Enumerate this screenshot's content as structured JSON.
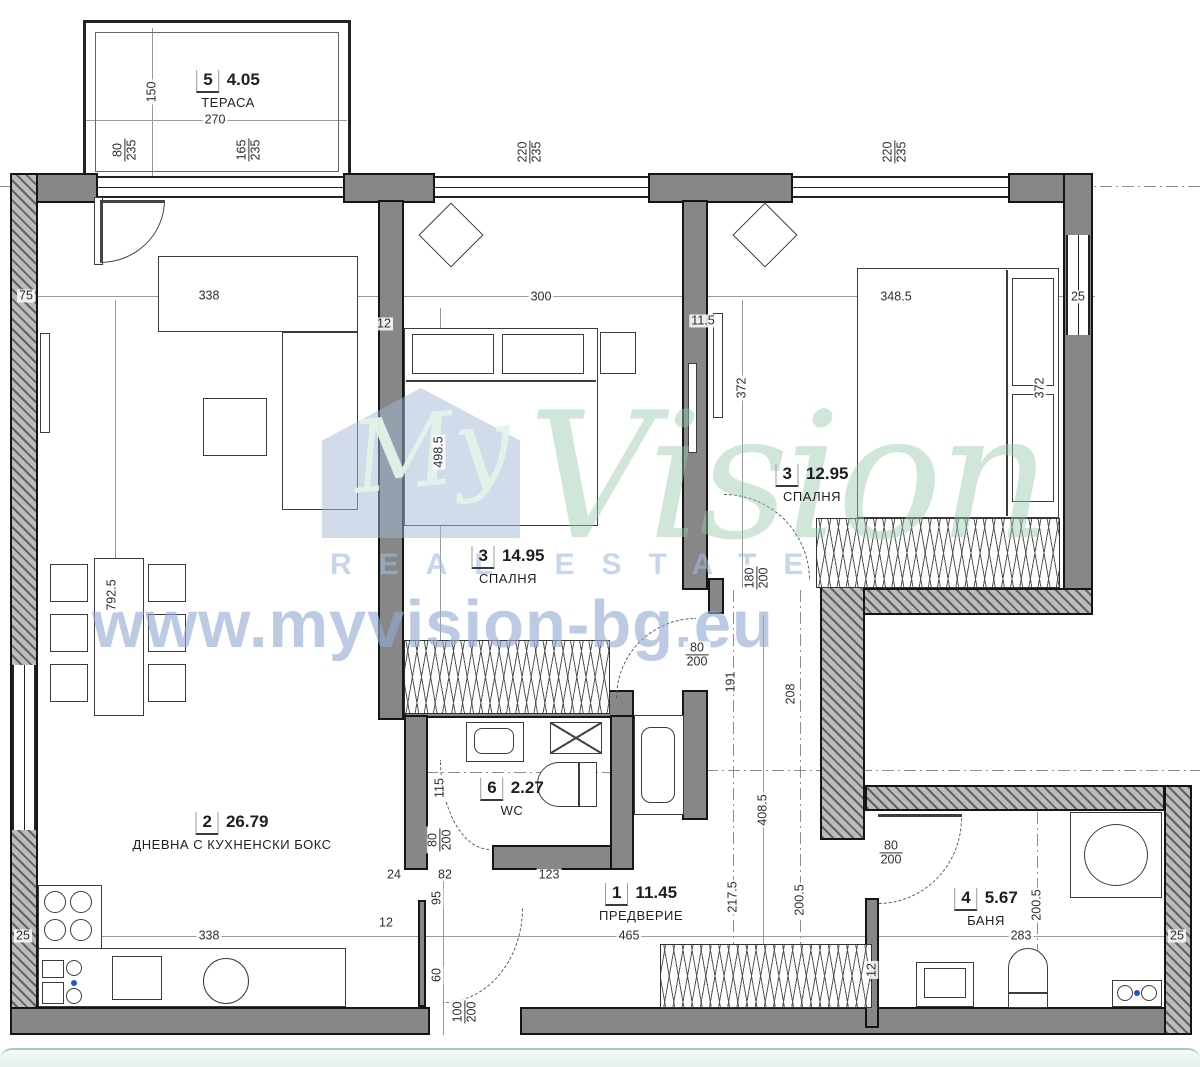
{
  "meta": {
    "width": 1200,
    "height": 1067,
    "drawing_type": "apartment floor plan"
  },
  "colors": {
    "wall_fill": "#878787",
    "wall_outline": "#151515",
    "hatch_fill": "#bcbcbc",
    "dim_text": "#2e2e2e",
    "watermark_green": "#96c7ab",
    "watermark_blue": "#94aad2",
    "band_green": "#a9cdb4"
  },
  "watermark": {
    "logo_text": "My",
    "brand": "Vision",
    "tagline": "REAL ESTATE",
    "url": "www.myvision-bg.eu"
  },
  "rooms": [
    {
      "num": "5",
      "area": "4.05",
      "name": "ТЕРАСА",
      "x": 228,
      "y": 70
    },
    {
      "num": "3",
      "area": "14.95",
      "name": "СПАЛНЯ",
      "x": 508,
      "y": 546
    },
    {
      "num": "3",
      "area": "12.95",
      "name": "СПАЛНЯ",
      "x": 812,
      "y": 464
    },
    {
      "num": "2",
      "area": "26.79",
      "name": "ДНЕВНА С КУХНЕНСКИ БОКС",
      "x": 232,
      "y": 812
    },
    {
      "num": "6",
      "area": "2.27",
      "name": "WC",
      "x": 512,
      "y": 778
    },
    {
      "num": "1",
      "area": "11.45",
      "name": "ПРЕДВЕРИЕ",
      "x": 641,
      "y": 883
    },
    {
      "num": "4",
      "area": "5.67",
      "name": "БАНЯ",
      "x": 986,
      "y": 888
    }
  ],
  "dimensions": [
    {
      "t": "150",
      "x": 152,
      "y": 92,
      "r": 1
    },
    {
      "t": "270",
      "x": 215,
      "y": 120
    },
    {
      "t": "80/235",
      "x": 125,
      "y": 150,
      "r": 1,
      "f": 1
    },
    {
      "t": "165/235",
      "x": 249,
      "y": 150,
      "r": 1,
      "f": 1
    },
    {
      "t": "220/235",
      "x": 530,
      "y": 152,
      "r": 1,
      "f": 1
    },
    {
      "t": "220/235",
      "x": 895,
      "y": 152,
      "r": 1,
      "f": 1
    },
    {
      "t": "75",
      "x": 26,
      "y": 296
    },
    {
      "t": "338",
      "x": 209,
      "y": 296
    },
    {
      "t": "12",
      "x": 384,
      "y": 324
    },
    {
      "t": "300",
      "x": 541,
      "y": 297
    },
    {
      "t": "11.5",
      "x": 703,
      "y": 321
    },
    {
      "t": "348.5",
      "x": 896,
      "y": 297
    },
    {
      "t": "25",
      "x": 1078,
      "y": 297
    },
    {
      "t": "792.5",
      "x": 112,
      "y": 595,
      "r": 1
    },
    {
      "t": "498.5",
      "x": 439,
      "y": 452,
      "r": 1
    },
    {
      "t": "372",
      "x": 742,
      "y": 388,
      "r": 1
    },
    {
      "t": "372",
      "x": 1040,
      "y": 388,
      "r": 1
    },
    {
      "t": "180/200",
      "x": 757,
      "y": 578,
      "r": 1,
      "f": 1
    },
    {
      "t": "80/200",
      "x": 697,
      "y": 655,
      "f": 1
    },
    {
      "t": "191",
      "x": 731,
      "y": 682,
      "r": 1
    },
    {
      "t": "208",
      "x": 791,
      "y": 694,
      "r": 1
    },
    {
      "t": "408.5",
      "x": 763,
      "y": 810,
      "r": 1
    },
    {
      "t": "115",
      "x": 440,
      "y": 788,
      "r": 1
    },
    {
      "t": "80/200",
      "x": 440,
      "y": 840,
      "r": 1,
      "f": 1
    },
    {
      "t": "95",
      "x": 437,
      "y": 898,
      "r": 1
    },
    {
      "t": "60",
      "x": 437,
      "y": 975,
      "r": 1
    },
    {
      "t": "12",
      "x": 386,
      "y": 923
    },
    {
      "t": "24",
      "x": 394,
      "y": 875
    },
    {
      "t": "82",
      "x": 445,
      "y": 875
    },
    {
      "t": "123",
      "x": 549,
      "y": 875
    },
    {
      "t": "100/200",
      "x": 465,
      "y": 1012,
      "r": 1,
      "f": 1
    },
    {
      "t": "465",
      "x": 629,
      "y": 936
    },
    {
      "t": "217.5",
      "x": 733,
      "y": 897,
      "r": 1
    },
    {
      "t": "200.5",
      "x": 800,
      "y": 900,
      "r": 1
    },
    {
      "t": "80/200",
      "x": 891,
      "y": 853,
      "f": 1
    },
    {
      "t": "12",
      "x": 872,
      "y": 970,
      "r": 1
    },
    {
      "t": "200.5",
      "x": 1037,
      "y": 905,
      "r": 1
    },
    {
      "t": "283",
      "x": 1021,
      "y": 936
    },
    {
      "t": "25",
      "x": 1177,
      "y": 936
    },
    {
      "t": "25",
      "x": 23,
      "y": 936
    },
    {
      "t": "338",
      "x": 209,
      "y": 936
    }
  ]
}
